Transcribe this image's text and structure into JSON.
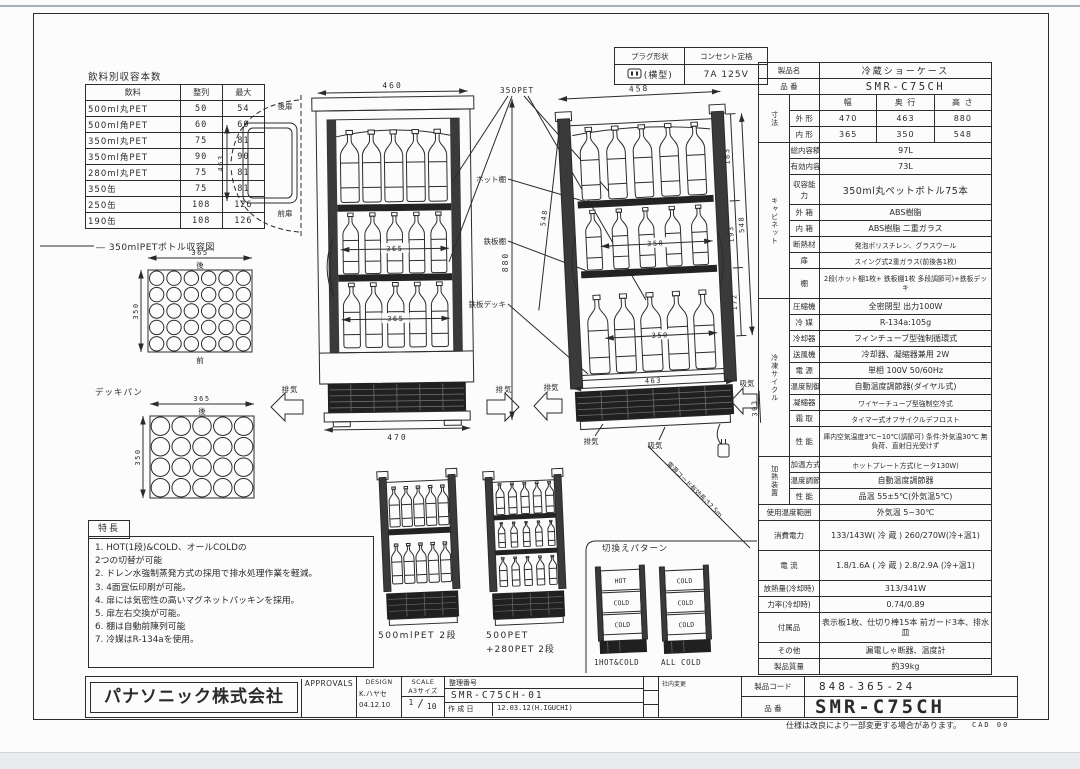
{
  "page": {
    "note": "仕様は改良により一部変更する場合があります。",
    "cad_note": "CAD 00"
  },
  "beverage_table": {
    "title": "飲料別収容本数",
    "headers": [
      "飲料",
      "整列",
      "最大"
    ],
    "rows": [
      [
        "500ml丸PET",
        "50",
        "54"
      ],
      [
        "500ml角PET",
        "60",
        "60"
      ],
      [
        "350ml丸PET",
        "75",
        "81"
      ],
      [
        "350ml角PET",
        "90",
        "90"
      ],
      [
        "280ml丸PET",
        "75",
        "81"
      ],
      [
        "350缶",
        "75",
        "81"
      ],
      [
        "250缶",
        "108",
        "126"
      ],
      [
        "190缶",
        "108",
        "126"
      ]
    ]
  },
  "plug_table": {
    "col1_header": "プラグ形状",
    "col2_header": "コンセント定格",
    "col1_value": "(横型)",
    "col2_value": "7A 125V"
  },
  "storage_diagram": {
    "title": "― 350mlPETボトル収容図",
    "deckpan_label": "デッキパン",
    "grid_a": {
      "top_dim": "365",
      "side_dim": "350",
      "back": "後",
      "front": "前",
      "cols": 6,
      "rows": 5
    },
    "grid_b": {
      "top_dim": "365",
      "side_dim": "350",
      "back": "後",
      "cols": 5,
      "rows": 4
    }
  },
  "features": {
    "title": "特長",
    "items": [
      "1. HOT(1段)&COLD、オールCOLDの\n  2つの切替が可能",
      "2. ドレン水強制蒸発方式の採用で排水処理作業を軽減。",
      "3. 4面宣伝印刷が可能。",
      "4. 扉には気密性の高いマグネットパッキンを採用。",
      "5. 扉左右交換が可能。",
      "6. 棚は自動前陳列可能",
      "7. 冷媒はR-134aを使用。"
    ]
  },
  "views": {
    "front": {
      "dim_top": "460",
      "dim_bottom": "470",
      "dim_shelf1": "365",
      "dim_shelf2": "365",
      "dim_height": "880",
      "exhaust_left": "排気",
      "exhaust_right": "排気",
      "pet_callout": "350PET",
      "hot_shelf": "ホット棚",
      "steel_shelf": "鉄板棚",
      "steel_deck": "鉄板デッキ"
    },
    "side_section": {
      "dim_top": "458",
      "dim_bottom": "463",
      "dim_inner": "548",
      "dim_p1": "183",
      "dim_p2": "193",
      "dim_p3": "172",
      "dim_base": "303",
      "dim_diag": "548",
      "dim_s1": "350",
      "dim_s2": "350",
      "exhaust": "排気",
      "intake": "吸気",
      "exhaust_small": "排気",
      "intake_small": "吸気",
      "cord": "電源コード有効長さ2.5m"
    },
    "top_swing": {
      "dim": "463",
      "rear": "後扉",
      "front": "前扉"
    }
  },
  "sub_units": {
    "a": "500mlPET 2段",
    "b1": "500PET",
    "b2": "+280PET 2段"
  },
  "switch_patterns": {
    "title": "切換えパターン",
    "unit1": {
      "shelves": [
        "HOT",
        "COLD",
        "COLD"
      ],
      "caption": "1HOT&COLD"
    },
    "unit2": {
      "shelves": [
        "COLD",
        "COLD",
        "COLD"
      ],
      "caption": "ALL COLD"
    }
  },
  "spec_table": {
    "rows": [
      {
        "label": "製品名",
        "value": "冷蔵ショーケース",
        "cls": "pname"
      },
      {
        "label": "品 番",
        "value": "SMR-C75CH",
        "cls": "model"
      },
      {
        "group": {
          "label": "寸法",
          "span": 3
        },
        "label": "",
        "cells": [
          "幅",
          "奥 行",
          "高 さ"
        ]
      },
      {
        "label": "外 形",
        "cells": [
          "470",
          "463",
          "880"
        ]
      },
      {
        "label": "内 形",
        "cells": [
          "365",
          "350",
          "548"
        ]
      },
      {
        "group": {
          "label": "キャビネット",
          "span": 8
        },
        "label": "総内容積",
        "value": "97L"
      },
      {
        "label": "有効内容積",
        "value": "73L"
      },
      {
        "label": "収容能力",
        "value": "350ml丸ペットボトル75本",
        "cls": "big",
        "h2": true
      },
      {
        "label": "外 箱",
        "value": "ABS樹脂"
      },
      {
        "label": "内 箱",
        "value": "ABS樹脂 二重ガラス"
      },
      {
        "label": "断熱材",
        "value": "発泡ポリスチレン、グラスウール",
        "cls": "sm"
      },
      {
        "label": "扉",
        "value": "スイング式2重ガラス(前後各1枚)",
        "cls": "sm"
      },
      {
        "label": "棚",
        "value": "2段(ホット棚1枚+\n鉄板棚1枚 多段調節可)+鉄板デッキ",
        "cls": "pre sm",
        "h2": true
      },
      {
        "group": {
          "label": "冷凍サイクル",
          "span": 9
        },
        "label": "圧縮機",
        "value": "全密閉型 出力100W"
      },
      {
        "label": "冷 媒",
        "value": "R-134a:105g"
      },
      {
        "label": "冷却器",
        "value": "フィンチューブ型強制循環式"
      },
      {
        "label": "送風機",
        "value": "冷却器、凝縮器兼用 2W"
      },
      {
        "label": "電 源",
        "value": "単相 100V  50/60Hz"
      },
      {
        "label": "温度制御",
        "value": "自動温度調節器(ダイヤル式)"
      },
      {
        "label": "凝縮器",
        "value": "ワイヤーチューブ型強制空冷式",
        "cls": "sm"
      },
      {
        "label": "霜 取",
        "value": "タイマー式オフサイクルデフロスト",
        "cls": "sm"
      },
      {
        "label": "性 能",
        "value": "庫内空気温度3℃~10℃(調節可)\n条件:外気温30℃ 無負荷、直射日光受けず",
        "cls": "pre sm",
        "h2": true
      },
      {
        "group": {
          "label": "加熱装置",
          "span": 3
        },
        "label": "加温方式",
        "value": "ホットプレート方式(ヒータ130W)",
        "cls": "sm"
      },
      {
        "label": "温度調節",
        "value": "自動温度調節器"
      },
      {
        "label": "性 能",
        "value": "品温 55±5℃(外気温5℃)"
      },
      {
        "label": "使用温度範囲",
        "value": "外気温 5~30℃"
      },
      {
        "label": "消費電力",
        "value": "133/143W( 冷 蔵 )\n260/270W(冷+温1)",
        "cls": "pre",
        "h2": true
      },
      {
        "label": "電 流",
        "value": "1.8/1.6A ( 冷 蔵 )\n2.8/2.9A (冷+温1)",
        "cls": "pre",
        "h2": true
      },
      {
        "label": "放熱量(冷却時)",
        "value": "313/341W"
      },
      {
        "label": "力率(冷却時)",
        "value": "0.74/0.89"
      },
      {
        "label": "付属品",
        "value": "表示板1枚、仕切り棒15本\n前ガード3本、排水皿",
        "cls": "pre",
        "h2": true
      },
      {
        "label": "その他",
        "value": "漏電しゃ断器、温度計"
      },
      {
        "label": "製品質量",
        "value": "約39kg"
      }
    ]
  },
  "title_block": {
    "company": "パナソニック株式会社",
    "approvals_header": "APPROVALS",
    "design_header": "DESIGN",
    "design_name": "K.ハヤセ",
    "design_date": "04.12.10",
    "scale_header": "SCALE",
    "scale_size": "A3サイズ",
    "scale_num": "1",
    "scale_den": "10",
    "doc_no_label": "整理番号",
    "doc_no": "SMR-C75CH-01",
    "created_label": "作 成 日",
    "created_value": "12.03.12(H.IGUCHI)",
    "revision_label": "社内変更",
    "product_code_label": "製品コード",
    "product_code": "848-365-24",
    "part_no_label": "品 番",
    "part_no": "SMR-C75CH"
  }
}
